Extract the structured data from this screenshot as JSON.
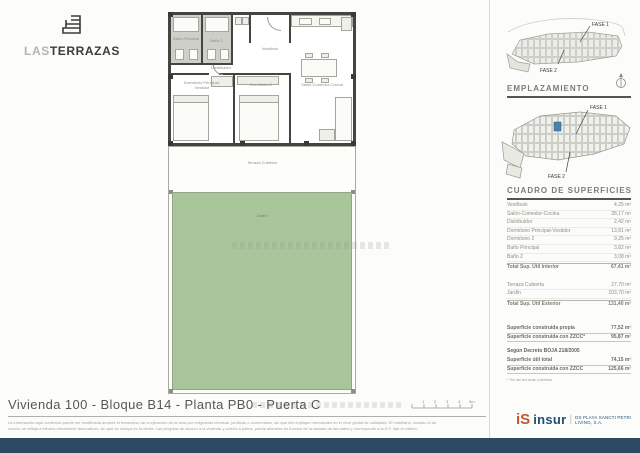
{
  "brand": {
    "word_light": "LAS",
    "word_bold": "TERRAZAS"
  },
  "site": {
    "fase1": "FASE 1",
    "fase2": "FASE 2",
    "emplazamiento": "EMPLAZAMIENTO"
  },
  "plan": {
    "bano_principal": "Baño Principal",
    "bano2": "Baño 2",
    "vestibulo": "Vestíbulo",
    "distribuidor": "Distribuidor",
    "dorm_principal": "Dormitorio Principal-Vestidor",
    "dorm2": "Dormitorio 2",
    "salon": "Salón-Comedor-Cocina",
    "terraza": "Terraza Cubierta",
    "jardin": "Jardín"
  },
  "surfaces": {
    "title": "CUADRO DE SUPERFICIES",
    "interior_rows": [
      {
        "label": "Vestíbulo",
        "value": "4,25 m²"
      },
      {
        "label": "Salón-Comedor-Cocina",
        "value": "28,17 m²"
      },
      {
        "label": "Distribuidor",
        "value": "2,42 m²"
      },
      {
        "label": "Dormitorio Principal-Vestidor",
        "value": "13,81 m²"
      },
      {
        "label": "Dormitorio 2",
        "value": "9,25 m²"
      },
      {
        "label": "Baño Principal",
        "value": "3,82 m²"
      },
      {
        "label": "Baño 2",
        "value": "3,08 m²"
      }
    ],
    "interior_total": {
      "label": "Total Sup. Útil Interior",
      "value": "67,41 m²"
    },
    "exterior_rows": [
      {
        "label": "Terraza Cubierta",
        "value": "27,70 m²"
      },
      {
        "label": "Jardín",
        "value": "103,70 m²"
      }
    ],
    "exterior_total": {
      "label": "Total Sup. Útil Exterior",
      "value": "131,40 m²"
    },
    "built_rows": [
      {
        "label": "Superficie construida propia",
        "value": "77,52 m²"
      },
      {
        "label": "Superficie construida con ZZCC*",
        "value": "95,87 m²"
      }
    ],
    "decree_heading": "Según Decreto BOJA 218/2005",
    "decree_rows": [
      {
        "label": "Superficie útil total",
        "value": "74,15 m²"
      },
      {
        "label": "Superficie construida con ZZCC",
        "value": "125,66 m²"
      }
    ],
    "footnote": "* Sin las terrazas cubiertas"
  },
  "footer": {
    "title": "Vivienda 100 - Bloque B14 - Planta PB0 - Puerta C",
    "disclaimer_line1": "La información aquí contenida puede ser modificada durante el transcurso de la ejecución de la obra por exigencias técnicas, jurídicas o comerciales, sin que ello implique menoscabo en el nivel global de calidades. El mobiliario, incluido el de",
    "disclaimer_line2": "cocina, se refleja a efectos meramente decorativos, sin que se incluya en la oferta. Las pérgolas de acceso a la vivienda y solería a patios, puede alterarse en función de la rasante de las calles y corresponde a la D.F. fijar el criterio.",
    "scale_labels": [
      "1",
      "2",
      "3",
      "4",
      "5m"
    ],
    "logo_mark": "iS",
    "logo_text": "insur",
    "company": "DS PLAYA SANCTI PETRI LIVING, S.A."
  },
  "colors": {
    "garden_green": "#a9c69b",
    "footer_bar": "#2d4a63",
    "insur_orange": "#c4562a",
    "insur_blue": "#1e4e79",
    "wall": "#45453f",
    "highlight_unit_blue": "#4f7fae"
  }
}
